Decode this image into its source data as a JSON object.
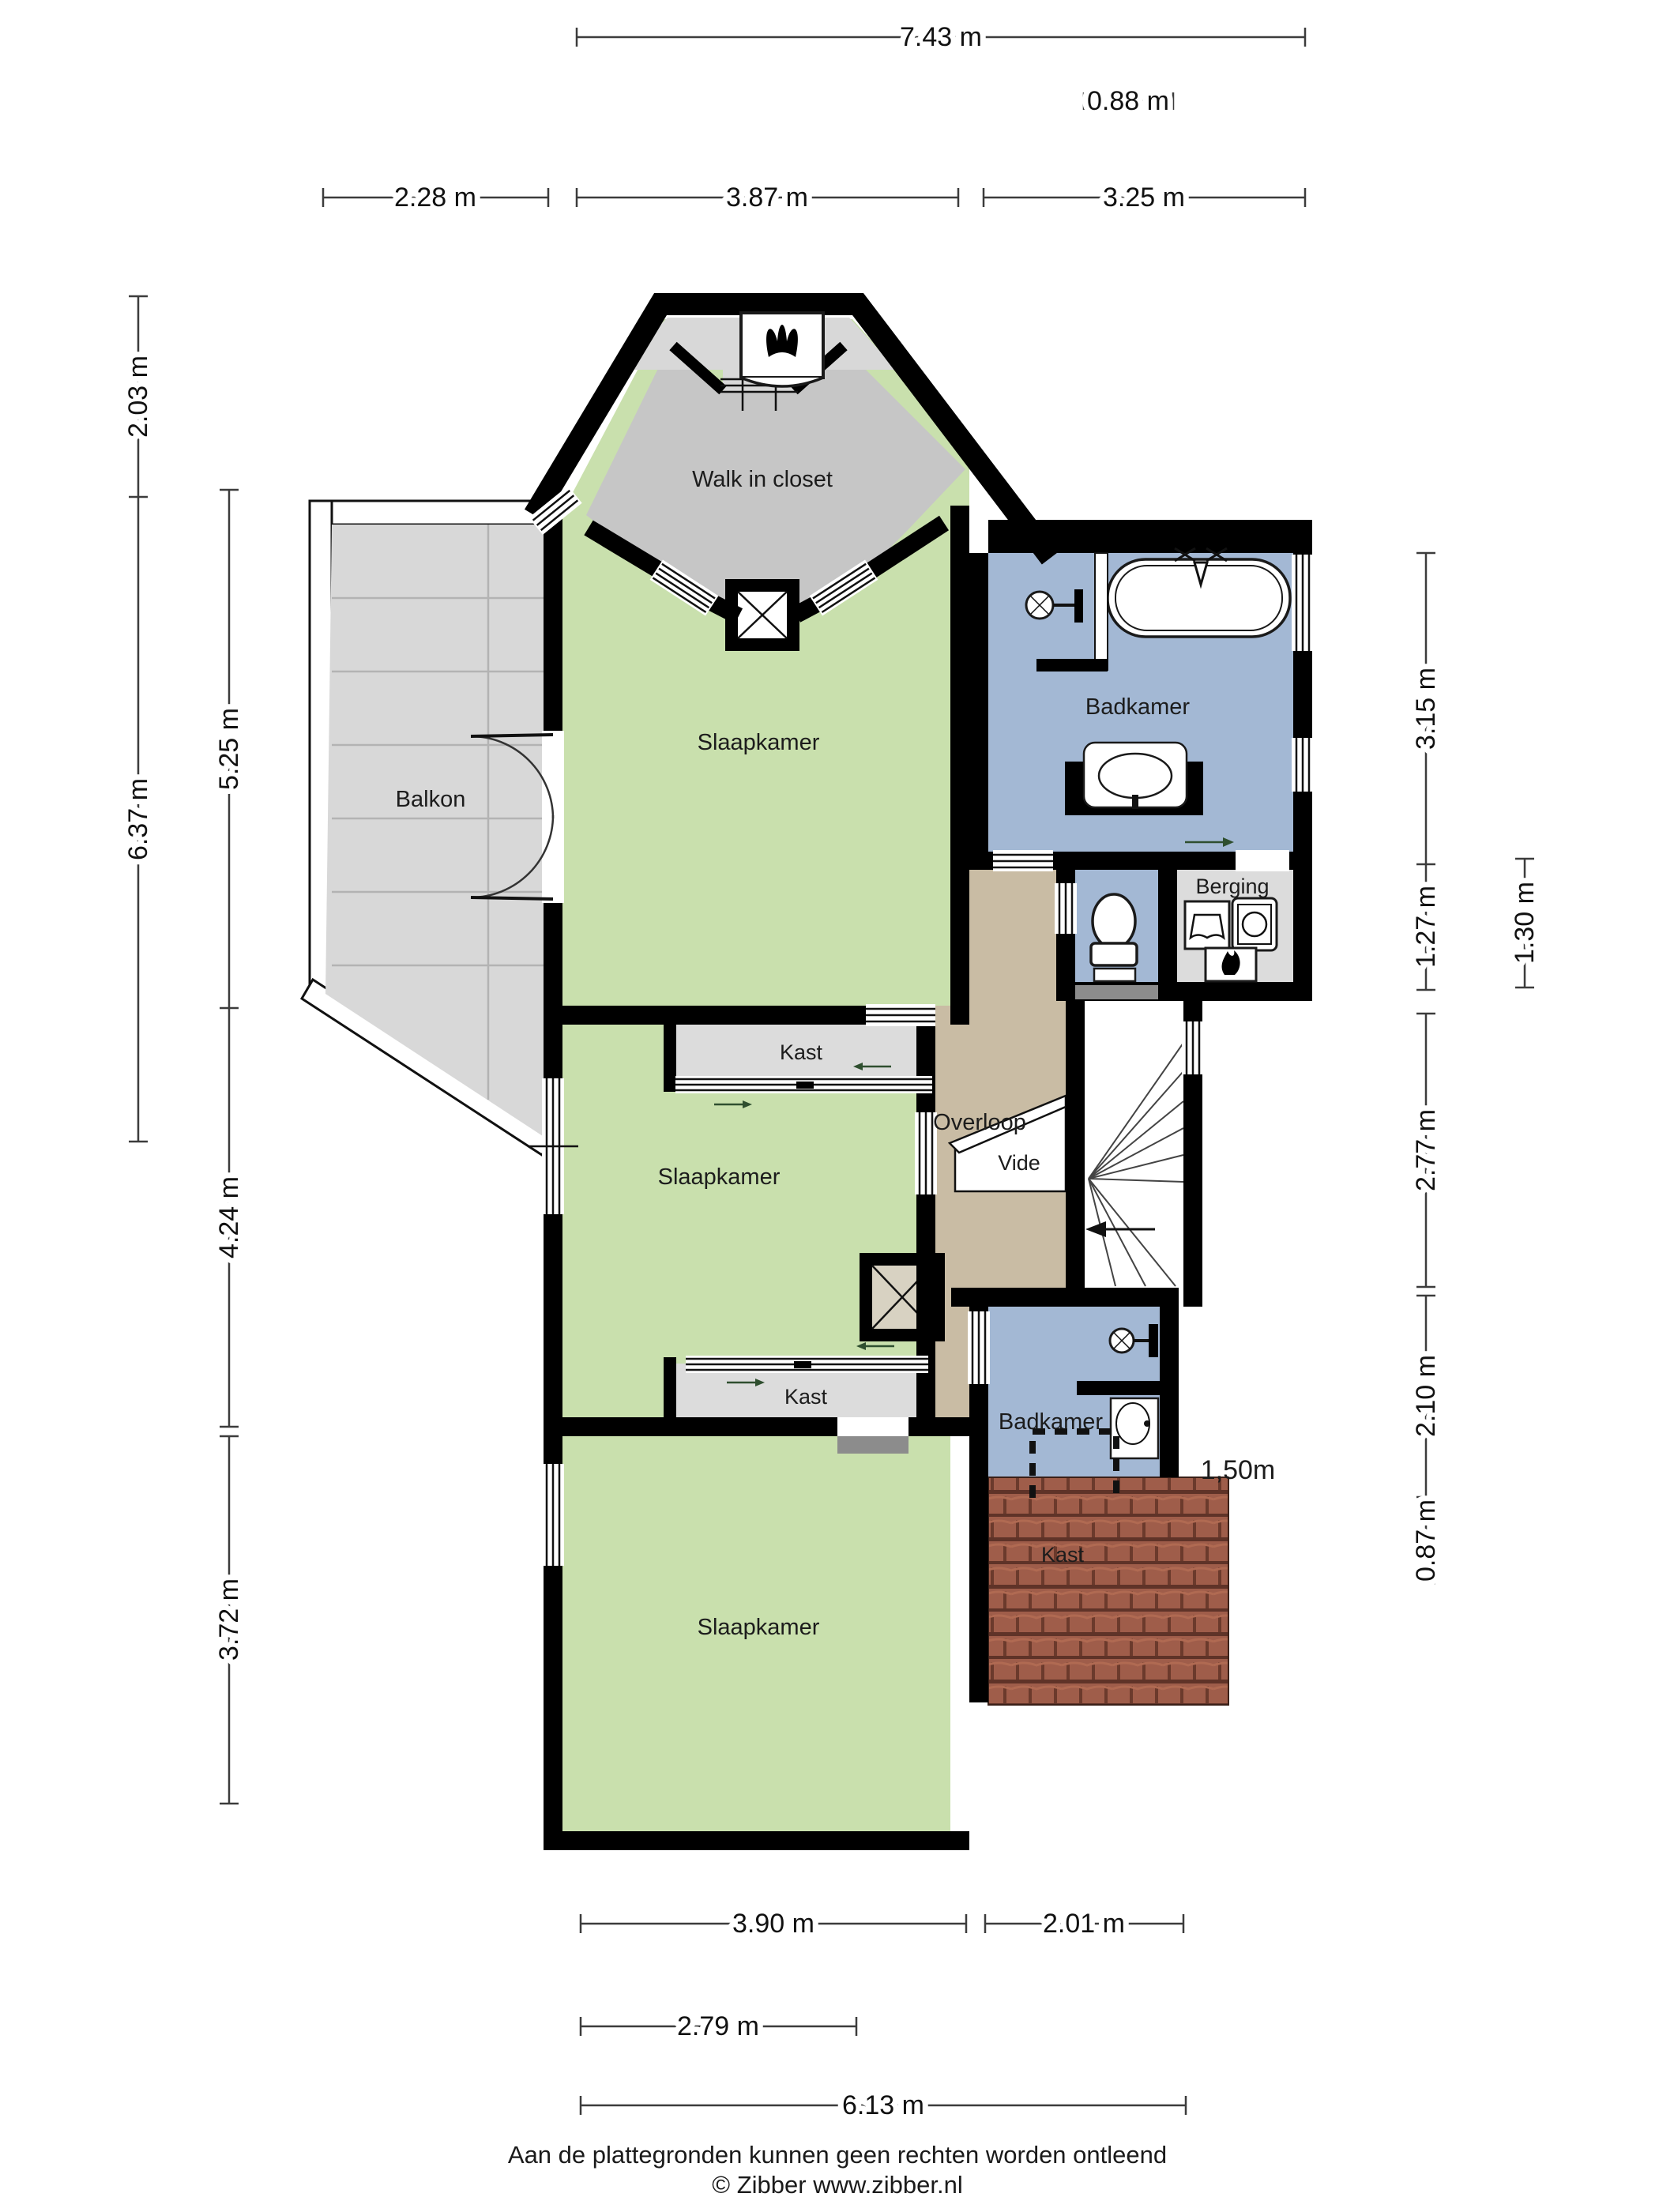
{
  "plan": {
    "rooms": {
      "walk_in_closet": "Walk in closet",
      "slaapkamer_1": "Slaapkamer",
      "slaapkamer_2": "Slaapkamer",
      "slaapkamer_3": "Slaapkamer",
      "badkamer_1": "Badkamer",
      "badkamer_2": "Badkamer",
      "berging": "Berging",
      "overloop": "Overloop",
      "vide": "Vide",
      "balkon": "Balkon",
      "kast_1": "Kast",
      "kast_2": "Kast",
      "kast_3": "Kast"
    },
    "annotations": {
      "headroom": "1,50m"
    },
    "colors": {
      "room_green": "#c9e0ad",
      "room_blue": "#a3b8d4",
      "hall_tan": "#c9bca4",
      "closet_gray": "#c6c6c6",
      "alcove_gray": "#d8d8d8",
      "light_gray": "#dcdcdc",
      "deck_gray": "#d8d8d8",
      "roof_tile": "#9f5d4a",
      "wall": "#000000"
    }
  },
  "dimensions": {
    "top": [
      "7.43 m",
      "0.88 m",
      "2.28 m",
      "3.87 m",
      "3.25 m"
    ],
    "left": [
      "2.03 m",
      "6.37 m",
      "5.25 m",
      "4.24 m",
      "3.72 m"
    ],
    "right": [
      "3.15 m",
      "1.27 m",
      "2.77 m",
      "2.10 m",
      "0.87 m",
      "1.30 m"
    ],
    "bottom": [
      "3.90 m",
      "2.01 m",
      "2.79 m",
      "6.13 m"
    ]
  },
  "footer": {
    "disclaimer": "Aan de plattegronden kunnen geen rechten worden ontleend",
    "copyright": "© Zibber www.zibber.nl"
  }
}
